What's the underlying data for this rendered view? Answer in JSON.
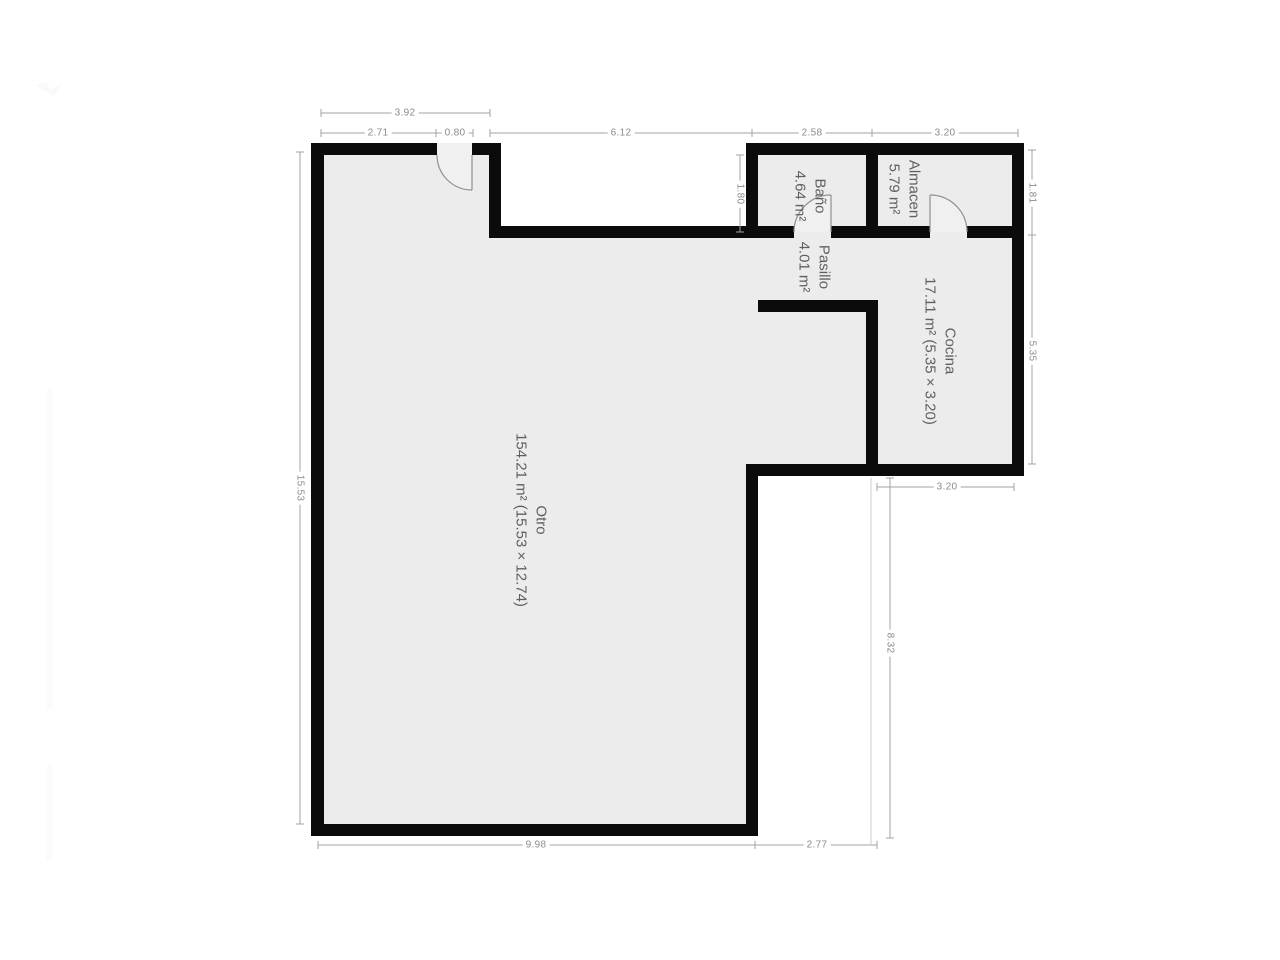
{
  "rooms": {
    "otro": {
      "name": "Otro",
      "area": "154.21 m² (15.53 × 12.74)"
    },
    "cocina": {
      "name": "Cocina",
      "area": "17.11 m² (5.35 × 3.20)"
    },
    "pasillo": {
      "name": "Pasillo",
      "area": "4.01 m²"
    },
    "bano": {
      "name": "Baño",
      "area": "4.64 m²"
    },
    "almacen": {
      "name": "Almacen",
      "area": "5.79 m²"
    }
  },
  "dims": {
    "top_overall": "3.92",
    "top_wall": "2.71",
    "top_door": "0.80",
    "notch_width": "6.12",
    "bano_width": "2.58",
    "almacen_width": "3.20",
    "notch_height": "1.80",
    "bano_height": "1.81",
    "cocina_height": "5.35",
    "left_height": "15.53",
    "cocina_width_bottom": "3.20",
    "extension_height": "8.32",
    "bottom_main": "9.98",
    "bottom_extension": "2.77"
  },
  "colors": {
    "bg": "#ffffff",
    "wall": "#0b0b0b",
    "floor": "#ececec",
    "doorfill": "#f0f0f0",
    "doorline": "#909090",
    "dimline": "#a3a3a3",
    "extline": "#cccccc",
    "dimtext": "#8b8b8b",
    "roomtext": "#606060"
  }
}
